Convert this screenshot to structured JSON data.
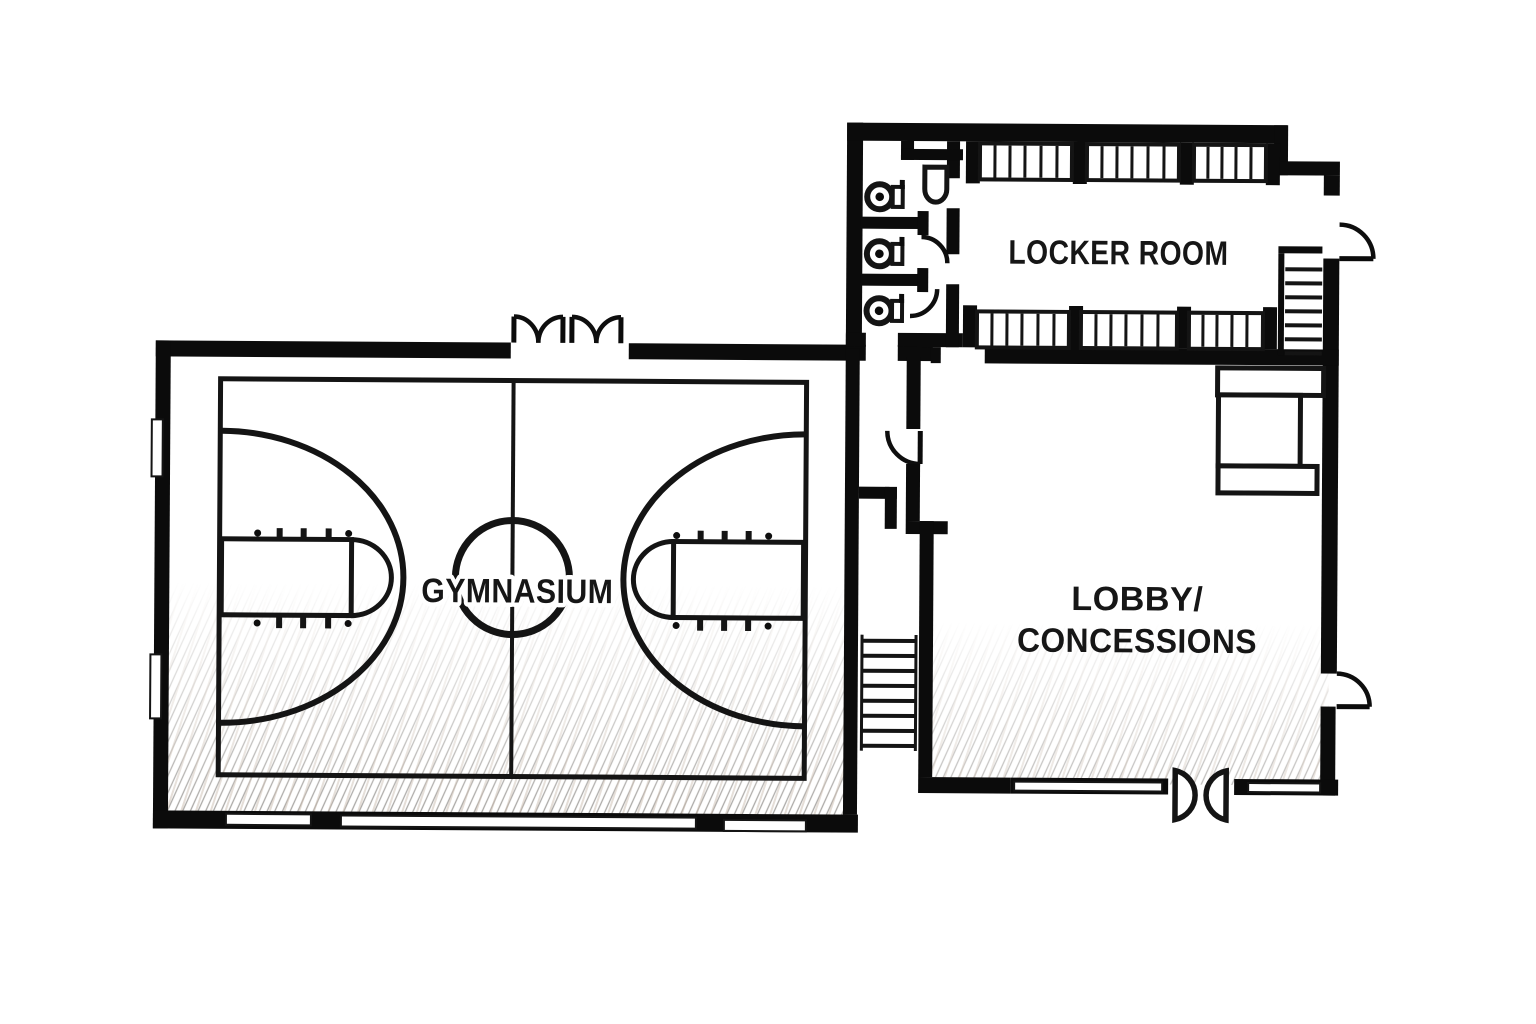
{
  "plan": {
    "background": "#ffffff",
    "wall_color": "#0b0b0b",
    "line_color": "#141414",
    "floor_hatch_color": "#46413b",
    "floor_tint_color": "#8a6b4f",
    "rooms": {
      "gymnasium": {
        "label": "GYMNASIUM"
      },
      "locker_room": {
        "label": "LOCKER ROOM"
      },
      "lobby": {
        "line1": "LOBBY/",
        "line2": "CONCESSIONS"
      }
    },
    "fixtures": {
      "toilets": 3,
      "toilet_stalls": 3,
      "sinks": 1,
      "locker_banks_top": 3,
      "locker_banks_bottom": 3,
      "staircases": 2,
      "gym_entry_double_doors": 2,
      "lobby_double_swing_doors": 1,
      "exterior_single_doors": 2,
      "interior_single_doors": 3,
      "windows_gym_left_wall": 2,
      "windows_gym_bottom_wall": 3,
      "windows_lobby_bottom_wall": 2,
      "concession_counters": 3,
      "basketball_court": {
        "center_circle": 1,
        "keys": 2,
        "three_point_arcs": 2,
        "center_line": 1
      }
    }
  }
}
